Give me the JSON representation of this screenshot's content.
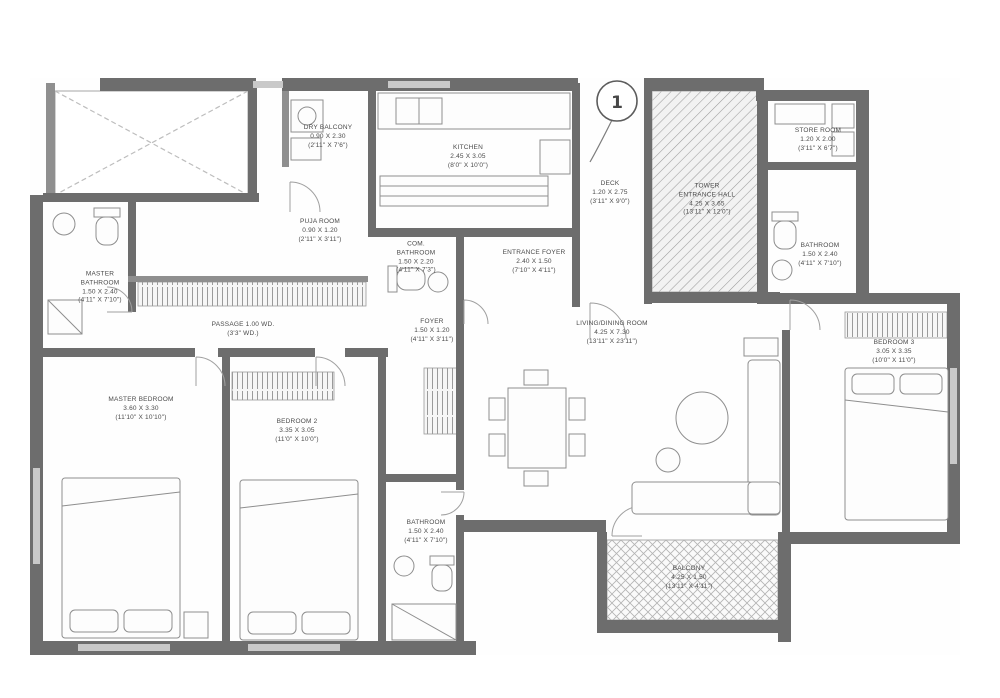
{
  "plan": {
    "title": "Apartment floor plan",
    "unit_number": "1",
    "colors": {
      "wall": "#6d6d6d",
      "wall_light": "#c9c9c9",
      "line": "#9a9a9a",
      "hatch": "#9c9c9c",
      "text": "#4a4a4a",
      "background": "#ffffff"
    },
    "rooms": {
      "dry_balcony": [
        "DRY BALCONY",
        "0.90 X 2.30",
        "(2'11\" X 7'6\")"
      ],
      "kitchen": [
        "KITCHEN",
        "2.45 X 3.05",
        "(8'0\" X 10'0\")"
      ],
      "puja": [
        "PUJA ROOM",
        "0.90 X 1.20",
        "(2'11\" X 3'11\")"
      ],
      "common_bath": [
        "COM.",
        "BATHROOM",
        "1.50 X 2.20",
        "(4'11\" X 7'3\")"
      ],
      "entrance_foyer": [
        "ENTRANCE FOYER",
        "2.40 X 1.50",
        "(7'10\" X 4'11\")"
      ],
      "deck": [
        "DECK",
        "1.20 X 2.75",
        "(3'11\" X 9'0\")"
      ],
      "tower_hall": [
        "TOWER",
        "ENTRANCE HALL",
        "4.25 X 3.65",
        "(13'11\" X 12'0\")"
      ],
      "store": [
        "STORE ROOM",
        "1.20 X 2.00",
        "(3'11\" X 6'7\")"
      ],
      "bath3": [
        "BATHROOM",
        "1.50 X 2.40",
        "(4'11\" X 7'10\")"
      ],
      "bedroom3": [
        "BEDROOM 3",
        "3.05 X 3.35",
        "(10'0\" X 11'0\")"
      ],
      "living": [
        "LIVING/DINING ROOM",
        "4.25 X 7.30",
        "(13'11\" X 23'11\")"
      ],
      "passage": [
        "PASSAGE 1.00 WD.",
        "(3'3\" WD.)"
      ],
      "foyer": [
        "FOYER",
        "1.50 X 1.20",
        "(4'11\" X 3'11\")"
      ],
      "master_bath": [
        "MASTER",
        "BATHROOM",
        "1.50 X 2.40",
        "(4'11\" X 7'10\")"
      ],
      "master_bed": [
        "MASTER BEDROOM",
        "3.60 X 3.30",
        "(11'10\" X 10'10\")"
      ],
      "bedroom2": [
        "BEDROOM 2",
        "3.35 X 3.05",
        "(11'0\" X 10'0\")"
      ],
      "bath2": [
        "BATHROOM",
        "1.50 X 2.40",
        "(4'11\" X 7'10\")"
      ],
      "balcony": [
        "BALCONY",
        "4.25 X 1.50",
        "(13'11\" X 4'11\")"
      ]
    },
    "icons": [
      "bed-icon",
      "wardrobe-icon",
      "dining-table-icon",
      "sofa-icon",
      "coffee-table-icon",
      "wc-icon",
      "washbasin-icon",
      "shower-icon",
      "kitchen-sink-icon",
      "washing-machine-icon",
      "unit-number-badge"
    ]
  }
}
